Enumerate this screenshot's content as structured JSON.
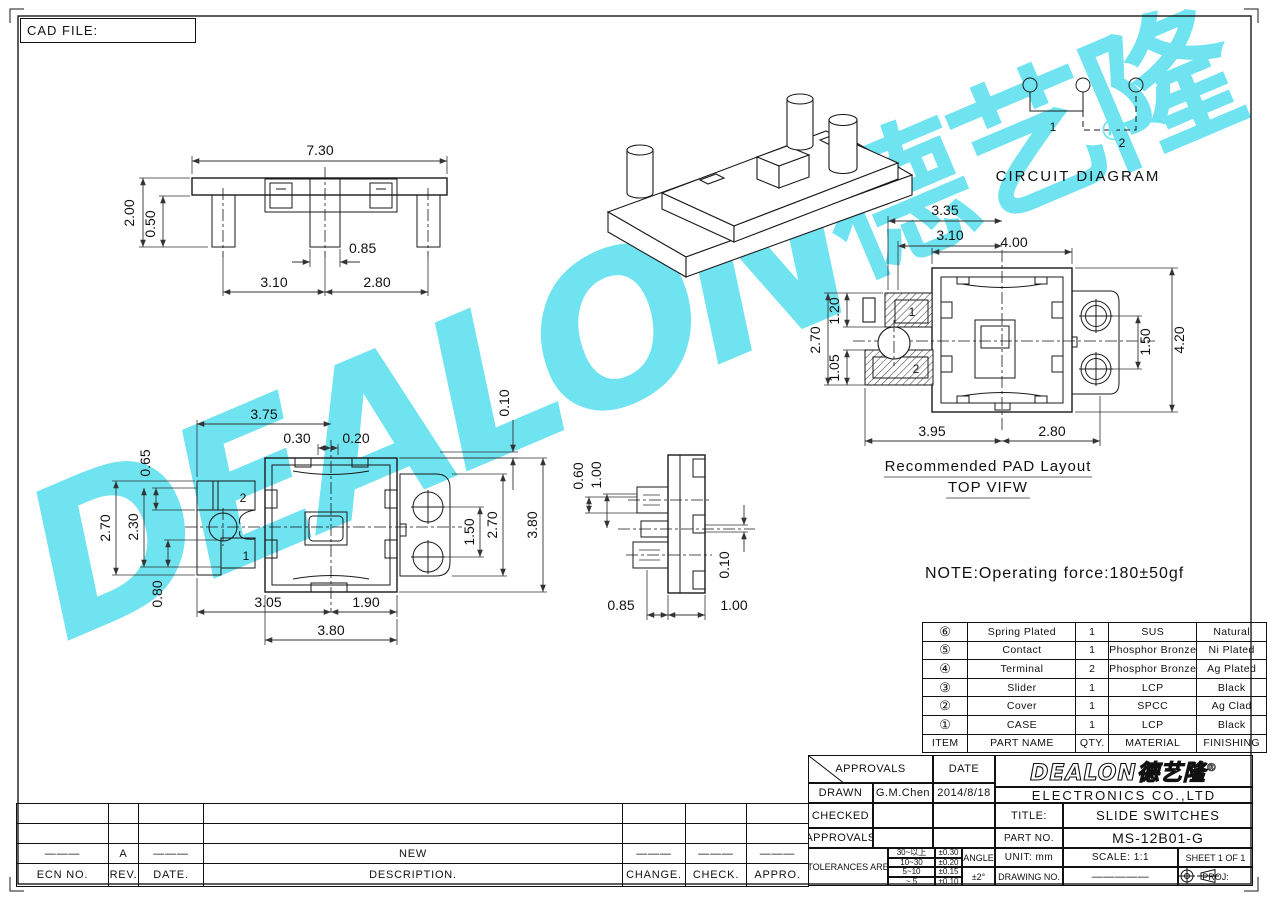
{
  "sheet": {
    "cad_file_label": "CAD FILE:",
    "note": "NOTE:Operating force:180±50gf",
    "pad_caption_line1": "Recommended PAD Layout",
    "pad_caption_line2": "TOP VIFW",
    "circuit_title": "CIRCUIT DIAGRAM"
  },
  "watermark": {
    "latin": "DEALON",
    "cjk": "德艺隆",
    "reg": "®",
    "color": "#6fe3f0"
  },
  "dims": {
    "front": {
      "w": "7.30",
      "h": "2.00",
      "leg": "0.50",
      "pin": "0.85",
      "dl": "3.10",
      "dr": "2.80"
    },
    "bottom": {
      "top": "3.75",
      "n1": "0.30",
      "n2": "0.20",
      "h1": "0.65",
      "h2": "2.70",
      "h3": "2.30",
      "h4": "0.80",
      "b1": "3.05",
      "b2": "1.90",
      "b3": "3.80",
      "t1": "0.10",
      "r1": "1.50",
      "r2": "2.70",
      "r3": "3.80",
      "p2": "2",
      "p1": "1"
    },
    "side": {
      "v1": "0.60",
      "v2": "1.00",
      "r": "0.10",
      "b1": "0.85",
      "b2": "1.00"
    },
    "pad": {
      "t1": "3.35",
      "t2": "3.10",
      "t3": "4.00",
      "l1": "2.70",
      "l2": "1.20",
      "l3": "1.05",
      "r1": "1.50",
      "r2": "4.20",
      "b1": "3.95",
      "b2": "2.80",
      "p1": "1",
      "p2": "2"
    },
    "circuit": {
      "n1": "1",
      "n2": "2"
    }
  },
  "parts_table": {
    "headers": {
      "item": "ITEM",
      "name": "PART NAME",
      "qty": "QTY.",
      "material": "MATERIAL",
      "finishing": "FINISHING"
    },
    "rows": [
      {
        "item": "⑥",
        "name": "Spring Plated",
        "qty": "1",
        "material": "SUS",
        "finishing": "Natural"
      },
      {
        "item": "⑤",
        "name": "Contact",
        "qty": "1",
        "material": "Phosphor Bronze",
        "finishing": "Ni Plated"
      },
      {
        "item": "④",
        "name": "Terminal",
        "qty": "2",
        "material": "Phosphor Bronze",
        "finishing": "Ag Plated"
      },
      {
        "item": "③",
        "name": "Slider",
        "qty": "1",
        "material": "LCP",
        "finishing": "Black"
      },
      {
        "item": "②",
        "name": "Cover",
        "qty": "1",
        "material": "SPCC",
        "finishing": "Ag Clad"
      },
      {
        "item": "①",
        "name": "CASE",
        "qty": "1",
        "material": "LCP",
        "finishing": "Black"
      }
    ]
  },
  "title_block": {
    "approvals_header": "APPROVALS",
    "date_header": "DATE",
    "drawn_label": "DRAWN",
    "drawn_name": "G.M.Chen",
    "drawn_date": "2014/8/18",
    "checked_label": "CHECKED",
    "approvals_label": "APPROVALS",
    "tolerances_label": "TOLERANCES ARE",
    "tol": [
      {
        "range": "30~以上",
        "val": "±0.30"
      },
      {
        "range": "10~30",
        "val": "±0.20"
      },
      {
        "range": "5~10",
        "val": "±0.15"
      },
      {
        "range": "~ 5",
        "val": "±0.10"
      }
    ],
    "angle_label": "ANGLE",
    "angle_value": "±2°",
    "logo_text": "DEALON",
    "logo_cjk": "德艺隆",
    "logo_reg": "®",
    "company": "ELECTRONICS CO.,LTD",
    "title_label": "TITLE:",
    "title_value": "SLIDE SWITCHES",
    "part_label": "PART NO.",
    "part_value": "MS-12B01-G",
    "unit_label": "UNIT: mm",
    "scale_label": "SCALE: 1:1",
    "sheet_label": "SHEET 1 OF 1",
    "drawing_label": "DRAWING NO.",
    "drawing_value": "—————",
    "proj_label": "PROJ:"
  },
  "revision_table": {
    "headers": {
      "ecn": "ECN NO.",
      "rev": "REV.",
      "date": "DATE.",
      "desc": "DESCRIPTION.",
      "change": "CHANGE.",
      "check": "CHECK.",
      "appro": "APPRO."
    },
    "rows": [
      {
        "ecn": "———",
        "rev": "A",
        "date": "———",
        "desc": "NEW",
        "change": "———",
        "check": "———",
        "appro": "———"
      }
    ]
  }
}
